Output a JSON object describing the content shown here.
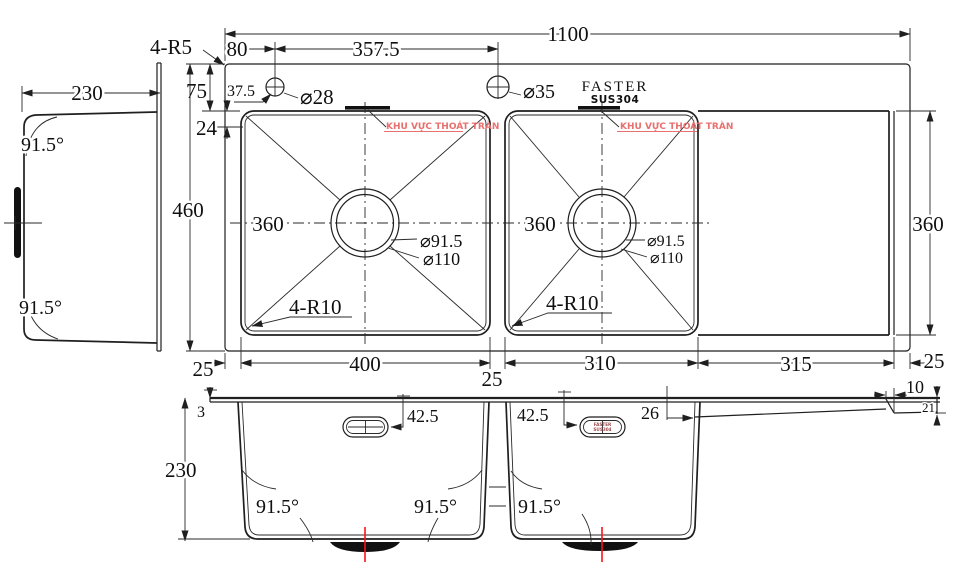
{
  "brand": {
    "name": "FASTER",
    "material": "SUS304"
  },
  "plan": {
    "total_width": "1100",
    "faucet_spacing": "357.5",
    "faucet_offset": "80",
    "faucet_inset": "37.5",
    "rim_corner_note": "4-R5",
    "rim_top": "75",
    "rim_fold": "24",
    "overall_depth": "460",
    "hole1_dia": "⌀28",
    "hole2_dia": "⌀35",
    "bowl1_width": "400",
    "bowl2_width": "310",
    "drainboard_width": "315",
    "drainboard_depth": "360",
    "margin": "25",
    "bowl_inner": "360",
    "drain_inner_dia": "⌀91.5",
    "drain_outer_dia": "⌀110",
    "bowl_corner_note": "4-R10",
    "overflow_note": "KHU VỰC THOÁT TRÀN"
  },
  "side": {
    "depth": "230",
    "angle": "91.5°"
  },
  "section": {
    "depth": "230",
    "angle": "91.5°",
    "rim_thickness": "3",
    "slot_offset": "42.5",
    "board_thickness": "26",
    "lip_width": "10",
    "lip_height": "21",
    "slot_brand": "FASTER",
    "slot_material": "SUS304"
  },
  "colors": {
    "line": "#1f1f1f",
    "centerline_red": "#ff1111",
    "note_red": "#e8706f"
  }
}
